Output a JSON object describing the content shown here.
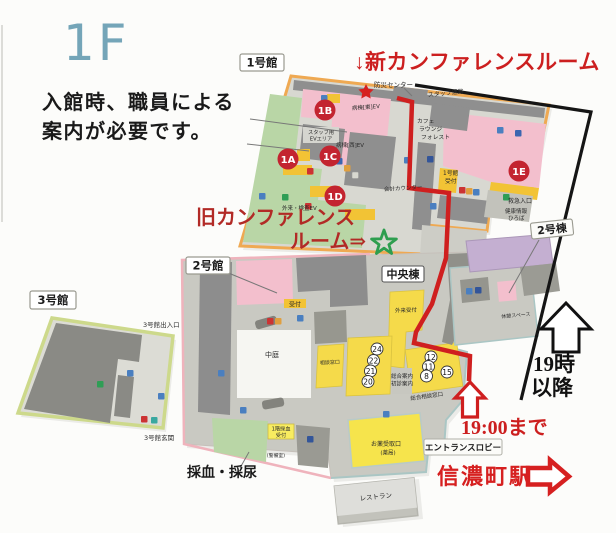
{
  "floor_label": "1F",
  "annotations": {
    "entry_note_line1": "入館時、職員による",
    "entry_note_line2": "案内が必要です。",
    "new_conference_label": "↓新カンファレンスルーム",
    "old_conference_line1": "旧カンファレンス",
    "old_conference_line2": "ルーム⇒",
    "after_19_line1": "19時",
    "after_19_line2": "以降",
    "until_19_label": "19:00まで",
    "station_label": "信濃町駅"
  },
  "buildings": {
    "bldg1_tag": "1号館",
    "bldg2_tag": "2号館",
    "bldg3_tag": "3号館",
    "central_tag": "中央棟",
    "tower2_tag": "2号棟",
    "entrance_lobby_tag": "エントランスロビー"
  },
  "badges": {
    "a1": "1A",
    "b1": "1B",
    "c1": "1C",
    "d1": "1D",
    "e1": "1E"
  },
  "numbers": {
    "n24": "24",
    "n22": "22",
    "n21": "21",
    "n20": "20",
    "n12": "12",
    "n11": "11",
    "n8": "8",
    "n15": "15"
  },
  "map_labels": {
    "bosai_center": "防災センター",
    "staff_corridor": "スタッフ通路",
    "staff_ev_1": "スタッフ用",
    "staff_ev_2": "EVエリア",
    "ward_east_ev": "病棟[東]EV",
    "ward_west_ev": "病棟[西]EV",
    "outpatient_ev": "外来・検査EV",
    "cafe_1": "カフェ",
    "cafe_2": "ラウンジ",
    "cafe_3": "フォレスト",
    "accounting_counter": "会計カウンター",
    "bldg1_reception_1": "1号館",
    "bldg1_reception_2": "受付",
    "emergency_entrance": "救急入口",
    "health_info_1": "健康情報",
    "health_info_2": "ひろば",
    "reception": "受付",
    "courtyard": "中庭",
    "consult_window_small": "相談窓口",
    "outpatient_reception": "外来受付",
    "general_info_1": "総合案内",
    "general_info_2": "初診案内",
    "consult_window": "総合相談窓口",
    "rest_space": "休憩スペース",
    "pharmacy_1": "お薬受取口",
    "pharmacy_2": "(薬局)",
    "blood_reception_1": "1階採血",
    "blood_reception_2": "受付",
    "security_room": "(警備室)",
    "blood_urine": "採血・採尿",
    "restaurant": "レストラン",
    "bldg3_exit_top": "3号館出入口",
    "bldg3_entrance": "3号館玄関"
  },
  "colors": {
    "floor_label_blue": "#74a5b8",
    "annotation_red": "#cc1f1f",
    "old_conference_red": "#b22a26",
    "route_red": "#cf1f1f",
    "marker_green": "#2e9e4f",
    "marker_red": "#d62020",
    "bldg1_border_orange": "#efa952",
    "bldg2_border_pink": "#efb3bc",
    "bldg3_border_green": "#cdd98b",
    "teal_border": "#aac6c4",
    "room_pink": "#f3bfcd",
    "room_yellow": "#f5da4a",
    "room_green": "#b9d6a6",
    "room_purple": "#c4afd1",
    "room_dark_gray": "#8e8e8e",
    "badge_red": "#c32430"
  }
}
